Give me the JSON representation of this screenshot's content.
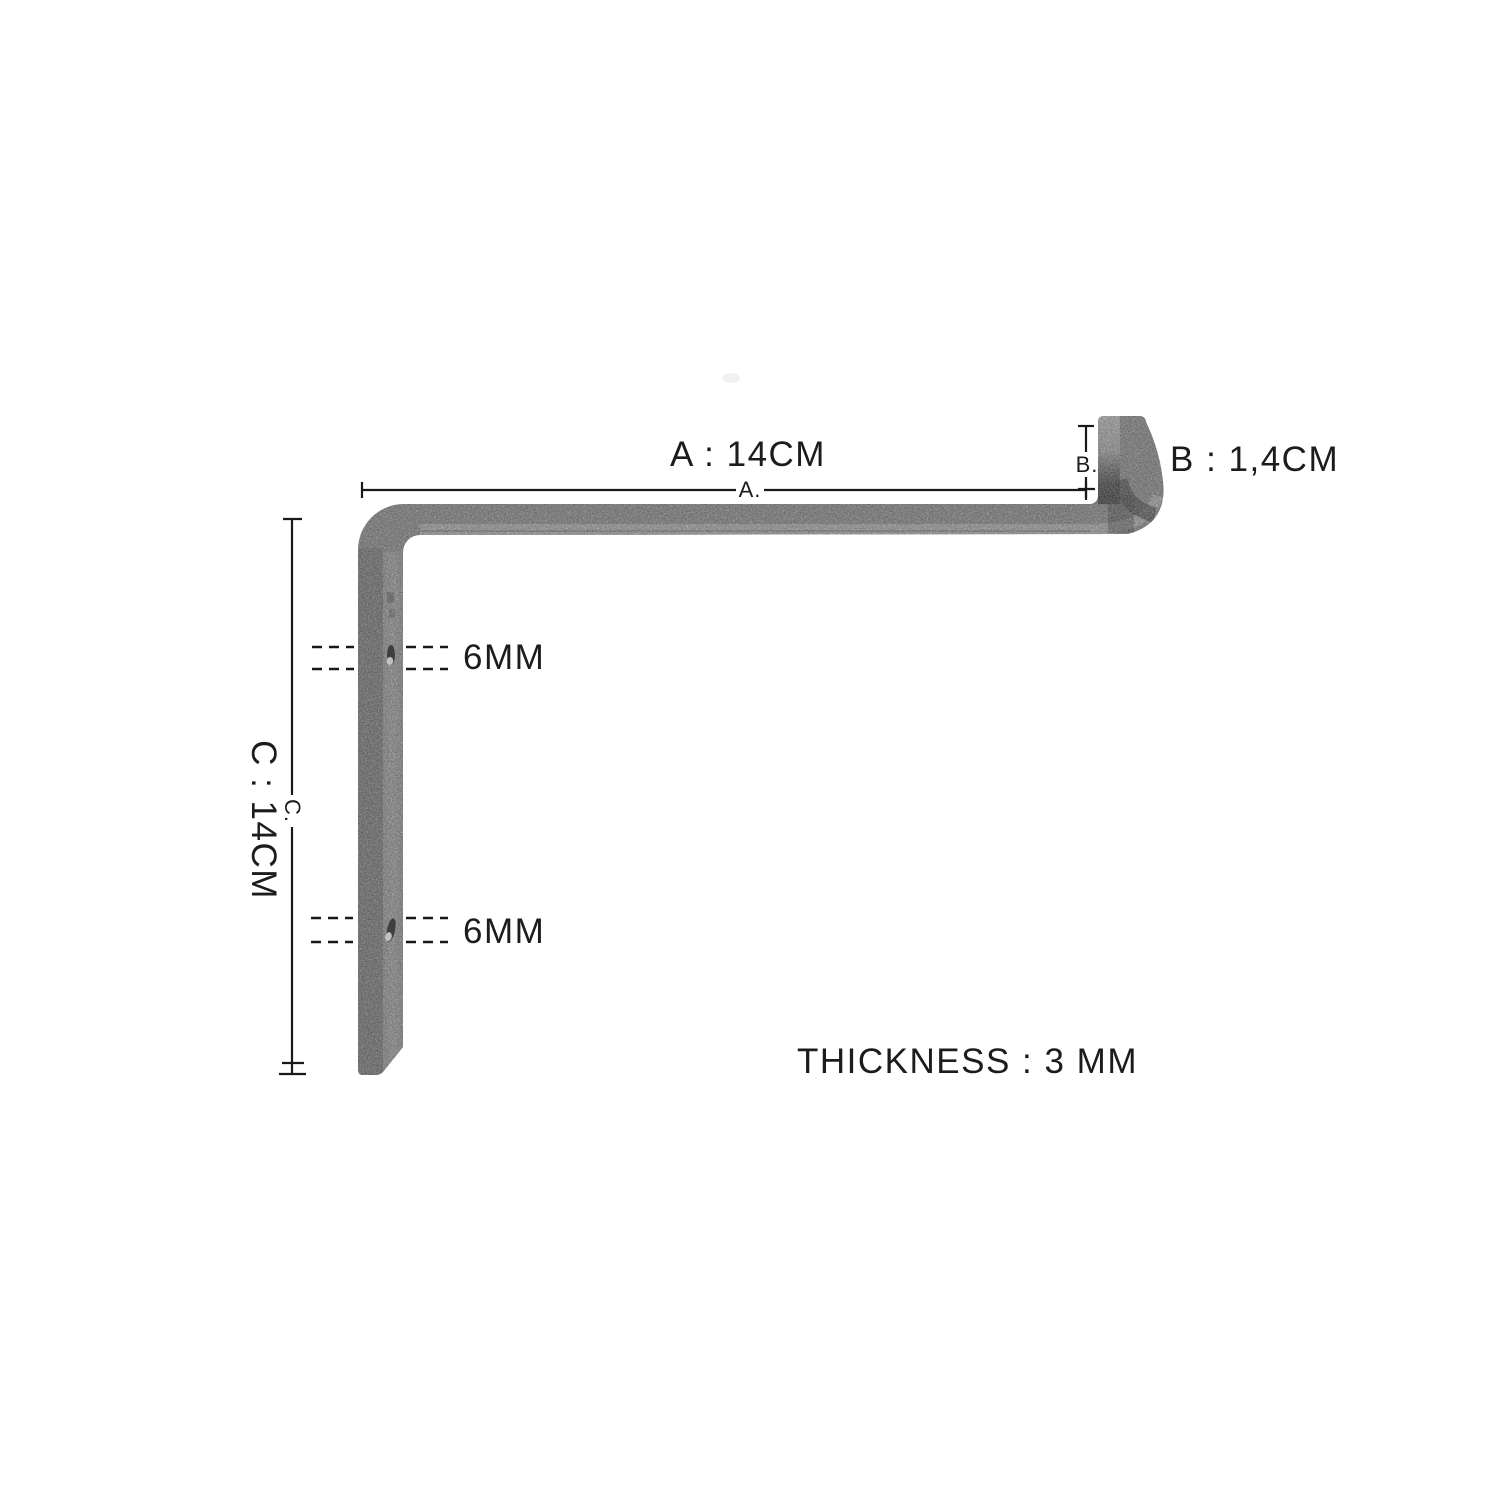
{
  "background": "#ffffff",
  "colors": {
    "line": "#191919",
    "text": "#1c1c1c",
    "metal_base": "#909090",
    "metal_side_dark": "#767676",
    "metal_face_light": "#a7a7a7",
    "metal_edge_light": "#bcbcbc",
    "metal_shadow_dark": "#3d3d3d"
  },
  "labels": {
    "dim_a": "A : 14CM",
    "dim_a_line": "A.",
    "dim_b": "B : 1,4CM",
    "dim_b_line": "B.",
    "dim_c": "C : 14CM",
    "dim_c_line": "C.",
    "hole_top": "6MM",
    "hole_bottom": "6MM",
    "thickness": "THICKNESS : 3 MM"
  }
}
